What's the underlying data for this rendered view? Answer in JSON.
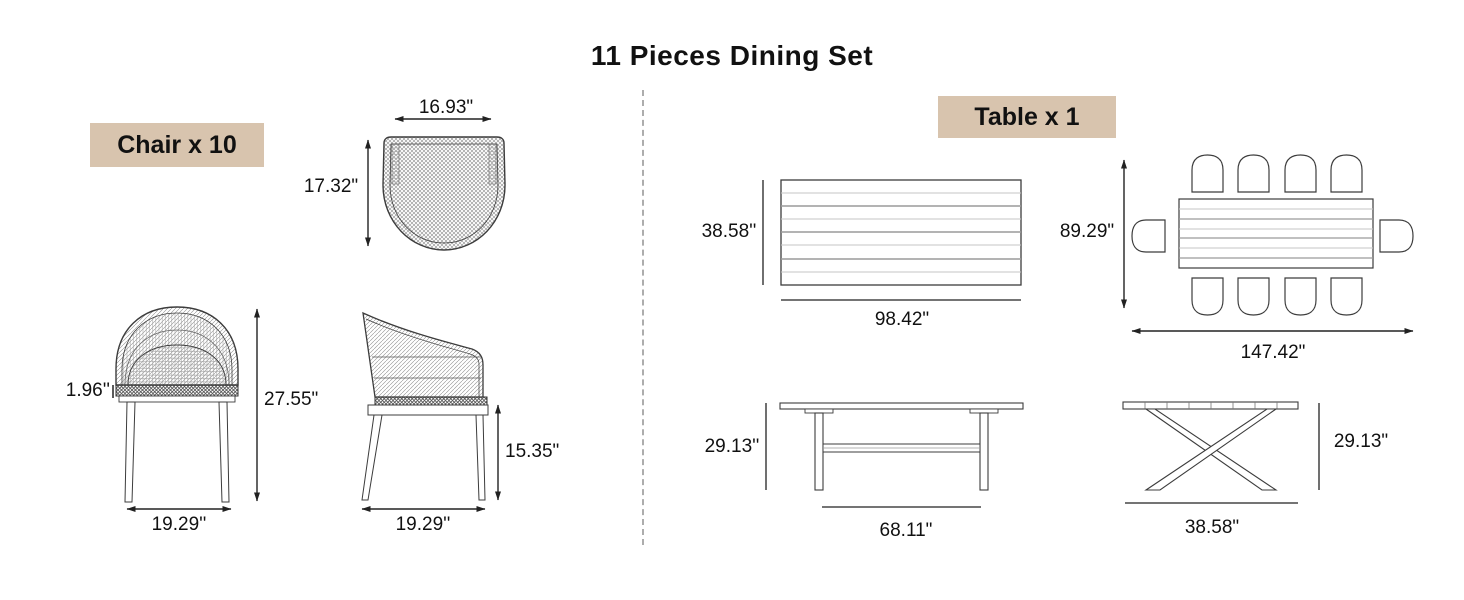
{
  "title": "11 Pieces Dining Set",
  "chair": {
    "label": "Chair x 10",
    "top_view": {
      "width": "16.93\"",
      "depth": "17.32\""
    },
    "front_view": {
      "frame_thickness": "1.96''",
      "height": "27.55\"",
      "width": "19.29''"
    },
    "side_view": {
      "seat_height": "15.35\"",
      "depth": "19.29''"
    }
  },
  "table": {
    "label": "Table x 1",
    "top_view": {
      "width": "38.58''",
      "length": "98.42\""
    },
    "layout_view": {
      "width": "89.29\"",
      "length": "147.42\""
    },
    "side_view": {
      "height": "29.13''",
      "leg_span": "68.11\""
    },
    "end_view": {
      "height": "29.13\"",
      "width": "38.58\""
    }
  },
  "colors": {
    "label_background": "#d8c4ae",
    "line": "#3c3c3c",
    "divider": "#adadad"
  }
}
